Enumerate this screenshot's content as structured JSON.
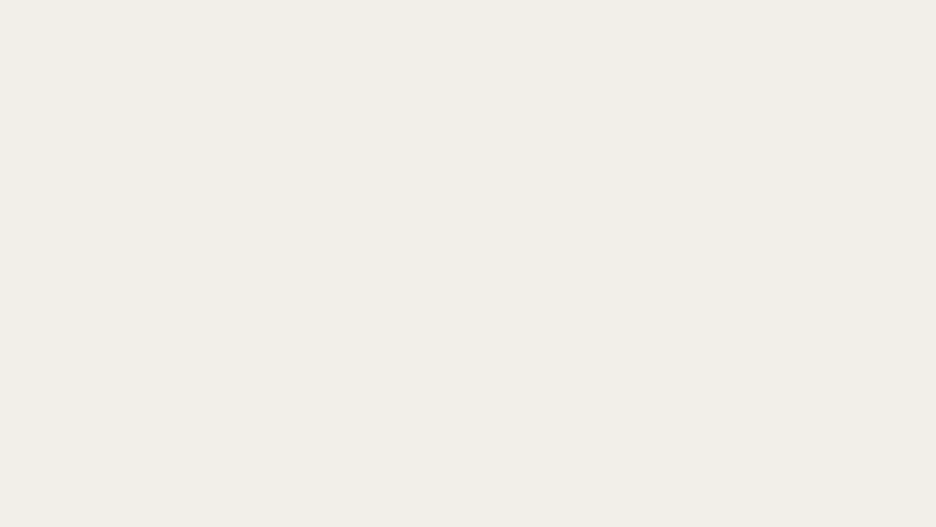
{
  "map": {
    "attribution": "OpenStreetMap",
    "colors": {
      "boundary": "#5b2fb8",
      "boundary_glow": "rgba(123,90,200,0.32)",
      "interior_fill": "#dad7e2",
      "street_label": "#474747",
      "cycleway": "#2337c8",
      "footpath": "#f97b72",
      "signal_fill": "#3aa3dd",
      "parking_blue": "#3d9bce",
      "cart_purple": "#a84fa8"
    },
    "boundary_points": [
      [
        253,
        131
      ],
      [
        365,
        129
      ],
      [
        438,
        170
      ],
      [
        441,
        112
      ],
      [
        470,
        121
      ],
      [
        565,
        147
      ],
      [
        600,
        171
      ],
      [
        741,
        226
      ],
      [
        752,
        233
      ],
      [
        754,
        266
      ],
      [
        747,
        273
      ],
      [
        740,
        292
      ],
      [
        727,
        322
      ],
      [
        711,
        343
      ],
      [
        688,
        389
      ],
      [
        672,
        403
      ],
      [
        600,
        399
      ],
      [
        520,
        397
      ],
      [
        455,
        400
      ],
      [
        378,
        401
      ],
      [
        300,
        403
      ],
      [
        232,
        397
      ],
      [
        196,
        390
      ],
      [
        176,
        388
      ],
      [
        167,
        381
      ],
      [
        196,
        357
      ],
      [
        209,
        264
      ],
      [
        217,
        238
      ],
      [
        253,
        131
      ]
    ],
    "labels": [
      {
        "text": "Favre",
        "x": 576,
        "y": 8,
        "rot": 0,
        "size": 12.5,
        "color": "#6a6a6a"
      },
      {
        "text": "Saint-John Perse",
        "x": 62,
        "y": 57,
        "rot": 0,
        "size": 11
      },
      {
        "text": "Parc du",
        "x": 177,
        "y": 59,
        "rot": 0,
        "size": 10.5,
        "color": "#46913e",
        "it": true
      },
      {
        "text": "ruisseau",
        "x": 176,
        "y": 72,
        "rot": 0,
        "size": 10.5,
        "color": "#46913e",
        "it": true
      },
      {
        "text": "du Laü",
        "x": 176,
        "y": 85,
        "rot": 0,
        "size": 10.5,
        "color": "#46913e",
        "it": true
      },
      {
        "text": "Allée François Truffaut",
        "x": 312,
        "y": 104,
        "rot": 2
      },
      {
        "text": "Rue André Mitton",
        "x": 300,
        "y": 118,
        "rot": 3
      },
      {
        "text": "Rue André Mitton",
        "x": 489,
        "y": 185,
        "rot": -14
      },
      {
        "text": "Rue du Ruisseau du Laü",
        "x": 512,
        "y": 124,
        "rot": 10
      },
      {
        "text": "Avenue Pierre Massé",
        "x": 462,
        "y": 73,
        "rot": -80
      },
      {
        "text": "Avenue Pierre Massé",
        "x": 391,
        "y": 287,
        "rot": -84
      },
      {
        "text": "Rue Ronsard",
        "x": 585,
        "y": 13,
        "rot": 9
      },
      {
        "text": "Rue André Maginot",
        "x": 557,
        "y": 40,
        "rot": 12
      },
      {
        "text": "Chemin Labriart",
        "x": 672,
        "y": 33,
        "rot": 10
      },
      {
        "text": "Chemin Labriart",
        "x": 811,
        "y": 58,
        "rot": 11
      },
      {
        "text": "Avenue",
        "x": 664,
        "y": 5,
        "rot": -55
      },
      {
        "text": "Avenue du Loup",
        "x": 604,
        "y": 92,
        "rot": -82
      },
      {
        "text": "Avenue du Loup",
        "x": 514,
        "y": 224,
        "rot": -65
      },
      {
        "text": "Avenue du Loup",
        "x": 470,
        "y": 313,
        "rot": -85
      },
      {
        "text": "Avenue du Loup",
        "x": 454,
        "y": 460,
        "rot": -88
      },
      {
        "text": "Avenue de Buros",
        "x": 772,
        "y": 196,
        "rot": -55
      },
      {
        "text": "Avenue de Buros",
        "x": 638,
        "y": 518,
        "rot": -75
      },
      {
        "text": "Rue Mozart",
        "x": 885,
        "y": 259,
        "rot": -20
      },
      {
        "text": "Rue Chopin",
        "x": 904,
        "y": 325,
        "rot": 68
      },
      {
        "text": "Rue Claude Debussy",
        "x": 838,
        "y": 351,
        "rot": 21
      },
      {
        "text": "Rue Massenet",
        "x": 757,
        "y": 376,
        "rot": 4
      },
      {
        "text": "Rue Berlioz",
        "x": 909,
        "y": 406,
        "rot": -78
      },
      {
        "text": "Rue Be",
        "x": 934,
        "y": 317,
        "rot": 80
      },
      {
        "text": "Chemin des Écoliers",
        "x": 691,
        "y": 247,
        "rot": 31
      },
      {
        "text": "Rue Jean Moulin",
        "x": 546,
        "y": 281,
        "rot": 10
      },
      {
        "text": "Rue de l'Aubisque",
        "x": 623,
        "y": 289,
        "rot": 21
      },
      {
        "text": "Rue d'Aspe",
        "x": 538,
        "y": 314,
        "rot": 12
      },
      {
        "text": "Rue Léon Jouhaux",
        "x": 576,
        "y": 345,
        "rot": -82
      },
      {
        "text": "Rue Saint-Exupéry",
        "x": 339,
        "y": 296,
        "rot": -83
      },
      {
        "text": "Rue Marc Sangnier",
        "x": 289,
        "y": 295,
        "rot": 8
      },
      {
        "text": "Rue Frédéric Ozanam",
        "x": 297,
        "y": 338,
        "rot": 8
      },
      {
        "text": "Avenue Pierre et Marie Curie",
        "x": 418,
        "y": 348,
        "rot": -85
      },
      {
        "text": "Le Hameau",
        "x": 339,
        "y": 391,
        "rot": 0,
        "size": 11,
        "color": "#a3804e"
      },
      {
        "text": "Boulevard Tourasse",
        "x": 616,
        "y": 406,
        "rot": 6
      },
      {
        "text": "Boulevard Tourasse",
        "x": 801,
        "y": 423,
        "rot": 12
      },
      {
        "text": "Rue des Magnolias",
        "x": 696,
        "y": 463,
        "rot": -4
      },
      {
        "text": "Rue Désirée Clary",
        "x": 806,
        "y": 477,
        "rot": -7
      },
      {
        "text": "Rue Auguste Renoir",
        "x": 381,
        "y": 468,
        "rot": 9
      },
      {
        "text": "Rue Pierre Bonnard",
        "x": 217,
        "y": 460,
        "rot": 8
      },
      {
        "text": "Rue d'Isly",
        "x": 205,
        "y": 498,
        "rot": 3
      },
      {
        "text": "Rue Lavoisier",
        "x": 95,
        "y": 431,
        "rot": 3
      },
      {
        "text": "Avenue du Président Kennedy",
        "x": 31,
        "y": 460,
        "rot": -88
      },
      {
        "text": "Piste cyclable UPPA Est",
        "x": 196,
        "y": 224,
        "rot": -78,
        "size": 9.5,
        "color": "#5a5a5a"
      },
      {
        "text": "Allée Condorcet",
        "x": 208,
        "y": 251,
        "rot": -80,
        "size": 11
      },
      {
        "text": "Allée",
        "x": 281,
        "y": 9,
        "rot": -62
      },
      {
        "text": "Lycée professionnel",
        "x": 531,
        "y": 77,
        "rot": 0,
        "size": 10.5,
        "color": "#6e6a55",
        "it": true
      },
      {
        "text": "Honoré",
        "x": 530,
        "y": 88,
        "rot": 0,
        "size": 10.5,
        "color": "#6e6a55",
        "it": true
      },
      {
        "text": "Baradat",
        "x": 532,
        "y": 99,
        "rot": 0,
        "size": 10.5,
        "color": "#6e6a55",
        "it": true
      },
      {
        "text": "École primaire",
        "x": 831,
        "y": 297,
        "rot": 0,
        "size": 10.5,
        "color": "#6e7d52",
        "it": true
      },
      {
        "text": "publique",
        "x": 830,
        "y": 310,
        "rot": 0,
        "size": 10.5,
        "color": "#6e7d52",
        "it": true
      },
      {
        "text": "Marancy",
        "x": 830,
        "y": 323,
        "rot": 0,
        "size": 10.5,
        "color": "#6e7d52",
        "it": true
      },
      {
        "text": "École primaire",
        "x": 66,
        "y": 516,
        "rot": 0,
        "size": 10.5,
        "color": "#6e7d52",
        "it": true
      },
      {
        "text": "publique",
        "x": 64,
        "y": 527,
        "rot": 0,
        "size": 10.5,
        "color": "#6e7d52",
        "it": true
      },
      {
        "text": "Stade des",
        "x": 602,
        "y": 488,
        "rot": 0,
        "size": 10.5,
        "color": "#349a60",
        "it": true
      },
      {
        "text": "Bleuets",
        "x": 599,
        "y": 500,
        "rot": 0,
        "size": 10.5,
        "color": "#349a60",
        "it": true
      },
      {
        "text": "de Notre-",
        "x": 600,
        "y": 511,
        "rot": 0,
        "size": 10.5,
        "color": "#349a60",
        "it": true
      },
      {
        "text": "Dame",
        "x": 598,
        "y": 522,
        "rot": 0,
        "size": 10.5,
        "color": "#349a60",
        "it": true
      },
      {
        "text": "La coulée verte",
        "x": 693,
        "y": 149,
        "rot": -75,
        "size": 10,
        "color": "#55a23c",
        "it": true
      },
      {
        "text": "Impasse",
        "x": 931,
        "y": 104,
        "rot": 24
      },
      {
        "text": "Bérard",
        "x": 9,
        "y": 352,
        "rot": 18
      },
      {
        "text": "Golda Meir",
        "x": 259,
        "y": 509,
        "rot": -86
      },
      {
        "text": "Gély",
        "x": 1,
        "y": 497,
        "rot": 0
      },
      {
        "text": "Avenue Fédérico Ga",
        "x": 523,
        "y": 487,
        "rot": 72
      }
    ],
    "icons": {
      "parking": [
        {
          "x": 289,
          "y": 84,
          "size": 26
        },
        {
          "x": 438,
          "y": 52,
          "size": 26
        },
        {
          "x": 166,
          "y": 236,
          "size": 21
        },
        {
          "x": 17,
          "y": 304,
          "size": 21
        },
        {
          "x": 73,
          "y": 327,
          "size": 21
        },
        {
          "x": 435,
          "y": 163,
          "size": 15,
          "color": "#3bb8cc"
        },
        {
          "x": 53,
          "y": 440,
          "size": 15
        },
        {
          "x": 232,
          "y": 490,
          "size": 17
        },
        {
          "x": 682,
          "y": 377,
          "size": 17
        }
      ],
      "parking_boxed": [
        {
          "x": 72,
          "y": 7
        },
        {
          "x": 122,
          "y": 11
        }
      ],
      "carts": [
        {
          "x": 362,
          "y": 53
        },
        {
          "x": 355,
          "y": 68
        },
        {
          "x": 443,
          "y": 355
        },
        {
          "x": 663,
          "y": 377
        },
        {
          "x": 87,
          "y": 411
        }
      ],
      "books": [
        {
          "x": 58,
          "y": 73
        },
        {
          "x": 39,
          "y": 97
        },
        {
          "x": 24,
          "y": 136
        },
        {
          "x": 39,
          "y": 159
        },
        {
          "x": 47,
          "y": 461
        },
        {
          "x": 12,
          "y": 220
        }
      ],
      "churches": [
        {
          "x": 105,
          "y": 487
        },
        {
          "x": 562,
          "y": 428
        }
      ],
      "scales": [
        {
          "x": 195,
          "y": 465
        }
      ],
      "cinema": [
        {
          "x": 432,
          "y": 150
        }
      ],
      "signals": [
        {
          "x": 266,
          "y": 52
        },
        {
          "x": 238,
          "y": 78
        },
        {
          "x": 252,
          "y": 81
        },
        {
          "x": 225,
          "y": 107
        },
        {
          "x": 615,
          "y": 61
        },
        {
          "x": 600,
          "y": 75
        },
        {
          "x": 838,
          "y": 80
        },
        {
          "x": 846,
          "y": 80
        },
        {
          "x": 863,
          "y": 3
        },
        {
          "x": 203,
          "y": 295
        },
        {
          "x": 220,
          "y": 385
        },
        {
          "x": 597,
          "y": 273
        },
        {
          "x": 601,
          "y": 283
        },
        {
          "x": 86,
          "y": 393
        },
        {
          "x": 173,
          "y": 431
        },
        {
          "x": 143,
          "y": 459
        },
        {
          "x": 157,
          "y": 464
        },
        {
          "x": 128,
          "y": 481
        },
        {
          "x": 229,
          "y": 493
        },
        {
          "x": 378,
          "y": 400
        },
        {
          "x": 750,
          "y": 412
        },
        {
          "x": 753,
          "y": 423
        },
        {
          "x": 881,
          "y": 443
        },
        {
          "x": 873,
          "y": 452
        },
        {
          "x": 919,
          "y": 462
        },
        {
          "x": 923,
          "y": 477
        }
      ],
      "arrows": [
        {
          "x": 376,
          "y": 11,
          "rot": -25
        },
        {
          "x": 458,
          "y": 108,
          "rot": 180
        },
        {
          "x": 508,
          "y": 38,
          "rot": 180
        },
        {
          "x": 530,
          "y": 178,
          "rot": -8
        },
        {
          "x": 440,
          "y": 302,
          "rot": 0
        },
        {
          "x": 135,
          "y": 382,
          "rot": 180
        },
        {
          "x": 212,
          "y": 403,
          "rot": 8
        },
        {
          "x": 133,
          "y": 463,
          "rot": 95
        },
        {
          "x": 404,
          "y": 449,
          "rot": 180
        }
      ]
    }
  }
}
